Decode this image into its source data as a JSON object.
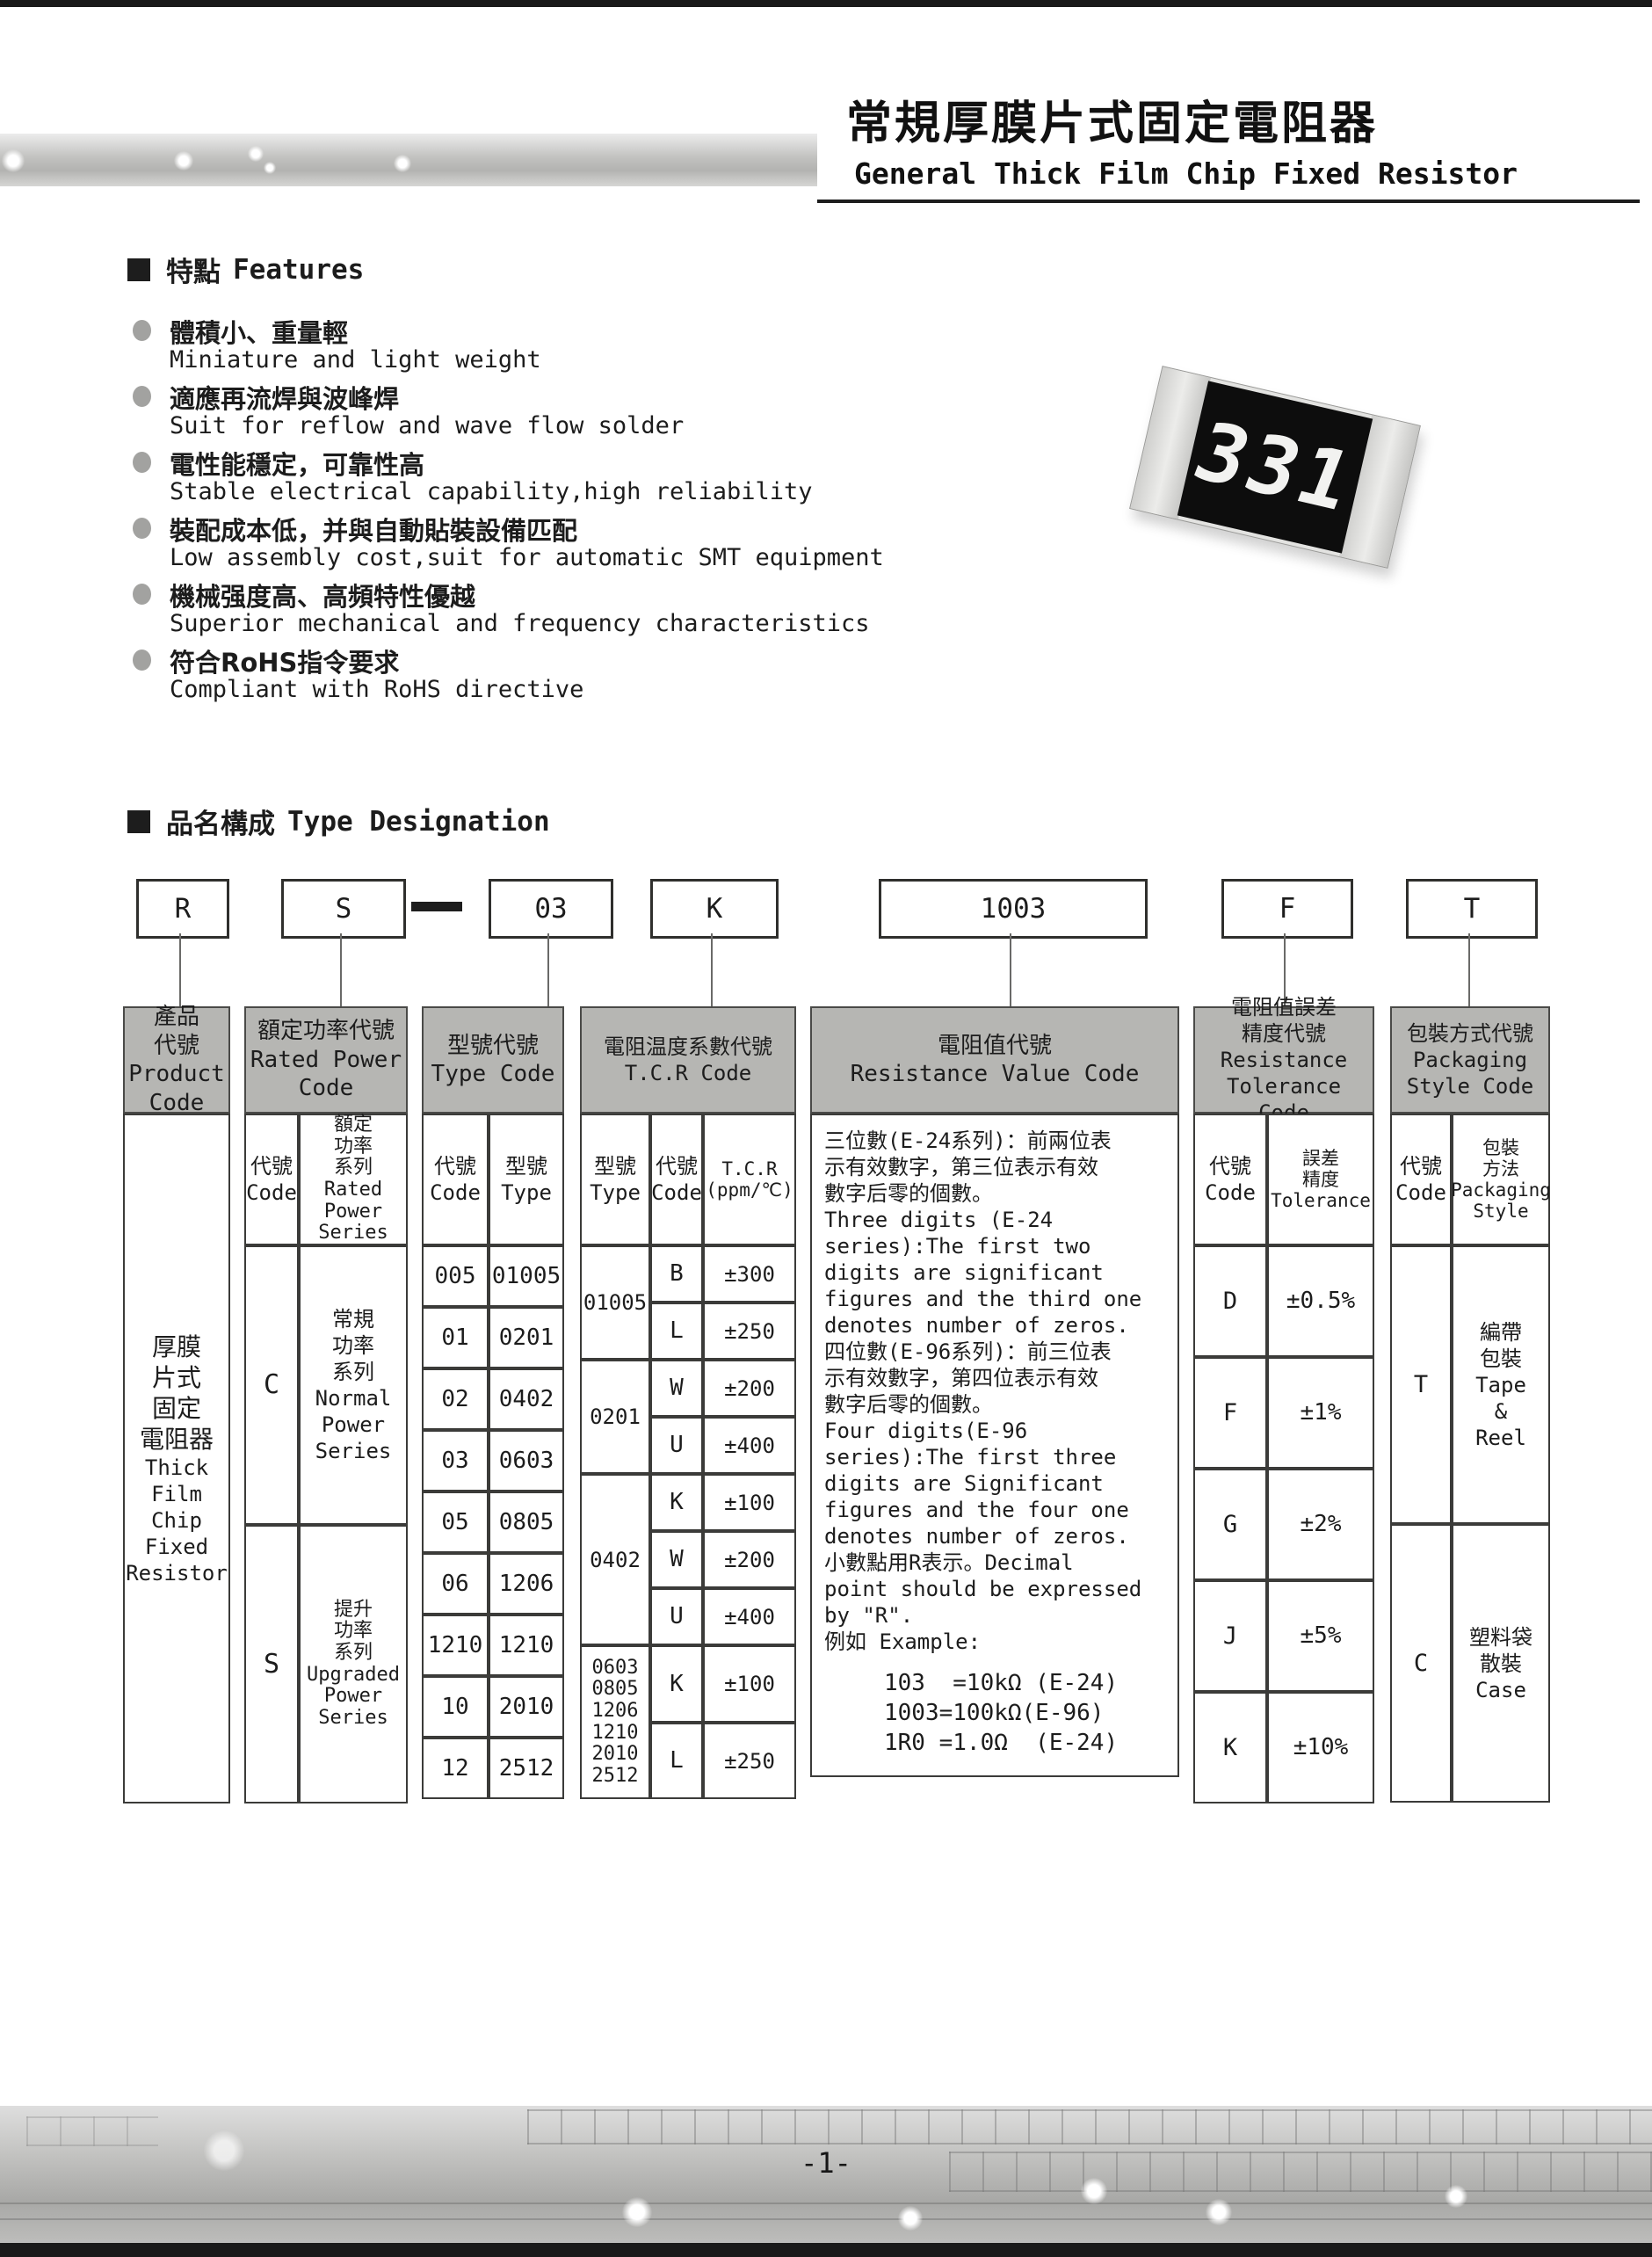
{
  "page": {
    "number": "-1-"
  },
  "header": {
    "title_zh": "常規厚膜片式固定電阻器",
    "title_en": "General Thick Film Chip Fixed Resistor"
  },
  "chip": {
    "marking": "331"
  },
  "features": {
    "heading_zh": "特點",
    "heading_en": "Features",
    "items": [
      {
        "zh": "體積小、重量輕",
        "en": "Miniature and light weight"
      },
      {
        "zh": "適應再流焊與波峰焊",
        "en": "Suit for reflow and wave flow solder"
      },
      {
        "zh": "電性能穩定，可靠性高",
        "en": "Stable electrical capability,high reliability"
      },
      {
        "zh": "裝配成本低，并與自動貼裝設備匹配",
        "en": "Low assembly cost,suit for automatic SMT equipment"
      },
      {
        "zh": "機械强度高、高頻特性優越",
        "en": "Superior mechanical and frequency characteristics"
      },
      {
        "zh": "符合RoHS指令要求",
        "en": "Compliant with RoHS directive"
      }
    ]
  },
  "designation": {
    "heading_zh": "品名構成",
    "heading_en": "Type Designation",
    "codes": [
      "R",
      "S",
      "03",
      "K",
      "1003",
      "F",
      "T"
    ]
  },
  "table": {
    "product": {
      "header": "產品\n代號\nProduct\nCode",
      "body_zh": "厚膜\n片式\n固定\n電阻器",
      "body_en": "Thick\nFilm\nChip\nFixed\nResistor"
    },
    "power": {
      "header": "額定功率代號\nRated Power\nCode",
      "sub_code": "代號\nCode",
      "sub_series": "額定\n功率\n系列\nRated\nPower\nSeries",
      "rows": [
        {
          "code": "C",
          "label": "常規\n功率\n系列\nNormal\nPower\nSeries"
        },
        {
          "code": "S",
          "label": "提升\n功率\n系列\nUpgraded\nPower\nSeries"
        }
      ]
    },
    "type": {
      "header": "型號代號\nType Code",
      "sub_code": "代號\nCode",
      "sub_type": "型號\nType",
      "rows": [
        [
          "005",
          "01005"
        ],
        [
          "01",
          "0201"
        ],
        [
          "02",
          "0402"
        ],
        [
          "03",
          "0603"
        ],
        [
          "05",
          "0805"
        ],
        [
          "06",
          "1206"
        ],
        [
          "1210",
          "1210"
        ],
        [
          "10",
          "2010"
        ],
        [
          "12",
          "2512"
        ]
      ]
    },
    "tcr": {
      "header": "電阻温度系數代號\nT.C.R Code",
      "sub_type": "型號\nType",
      "sub_code": "代號\nCode",
      "sub_tcr": "T.C.R\n(ppm/℃)",
      "groups": [
        {
          "type": "01005"
        },
        {
          "type": "0201"
        },
        {
          "type": "0402"
        },
        {
          "type": "0603\n0805\n1206\n1210\n2010\n2512"
        }
      ],
      "rows": [
        [
          "B",
          "±300"
        ],
        [
          "L",
          "±250"
        ],
        [
          "W",
          "±200"
        ],
        [
          "U",
          "±400"
        ],
        [
          "K",
          "±100"
        ],
        [
          "W",
          "±200"
        ],
        [
          "U",
          "±400"
        ],
        [
          "K",
          "±100"
        ],
        [
          "L",
          "±250"
        ]
      ]
    },
    "resistance": {
      "header": "電阻值代號\nResistance Value Code",
      "body": "三位數(E-24系列)：前兩位表\n示有效數字，第三位表示有效\n數字后零的個數。\nThree digits (E-24\nseries):The first two\ndigits are significant\nfigures and the third one\ndenotes number of zeros.\n四位數(E-96系列)：前三位表\n示有效數字，第四位表示有效\n數字后零的個數。\nFour digits(E-96\nseries):The first three\ndigits are Significant\nfigures and the four one\ndenotes number of zeros.\n小數點用R表示。Decimal\npoint should be expressed\nby \"R\".\n例如 Example:",
      "examples": "103  =10kΩ (E-24)\n1003=100kΩ(E-96)\n1R0 =1.0Ω  (E-24)"
    },
    "tolerance": {
      "header": "電阻值誤差\n精度代號\nResistance\nTolerance Code",
      "sub_code": "代號\nCode",
      "sub_tol": "誤差\n精度\nTolerance",
      "rows": [
        [
          "D",
          "±0.5%"
        ],
        [
          "F",
          "±1%"
        ],
        [
          "G",
          "±2%"
        ],
        [
          "J",
          "±5%"
        ],
        [
          "K",
          "±10%"
        ]
      ]
    },
    "packaging": {
      "header": "包裝方式代號\nPackaging\nStyle Code",
      "sub_code": "代號\nCode",
      "sub_style": "包裝\n方法\nPackaging\nStyle",
      "rows": [
        {
          "code": "T",
          "label": "編帶\n包裝\nTape\n&\nReel"
        },
        {
          "code": "C",
          "label": "塑料袋\n散裝\nCase"
        }
      ]
    }
  }
}
